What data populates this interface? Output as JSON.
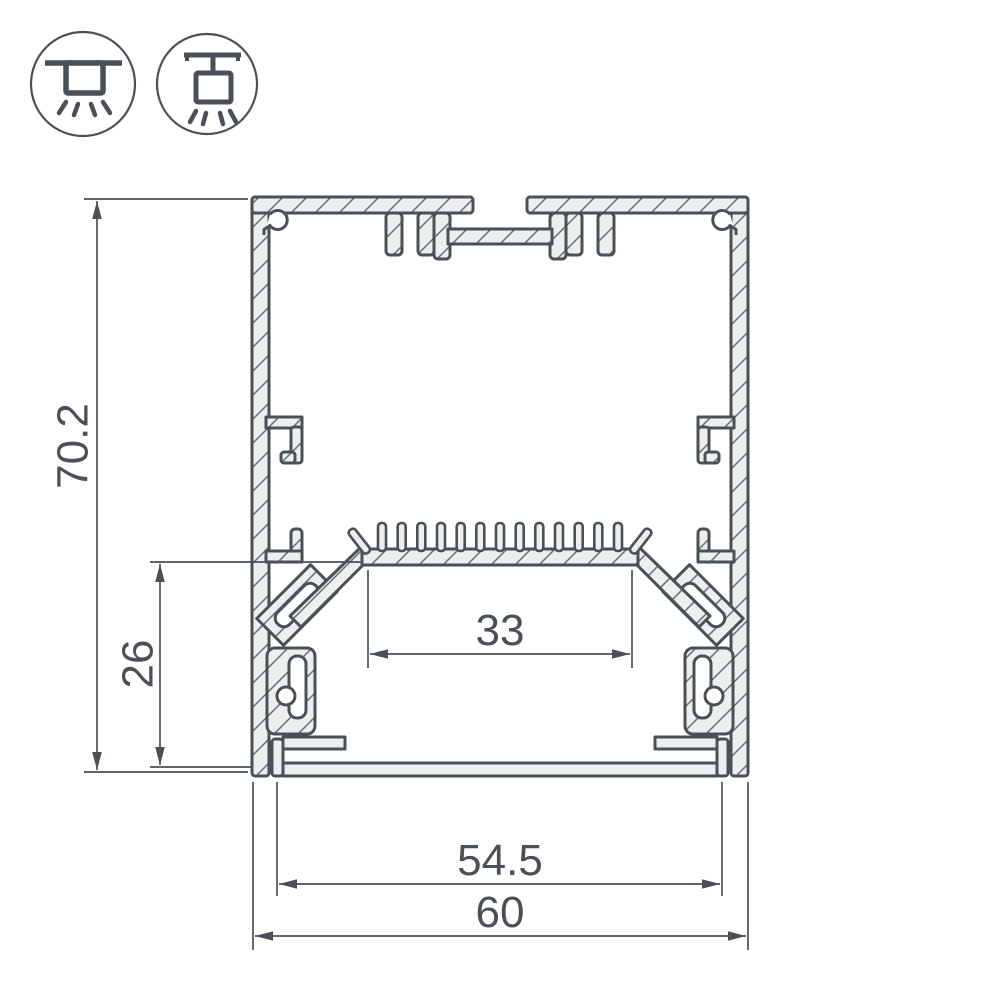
{
  "icons": {
    "surface_mounted": "surface-mounted-luminaire",
    "suspended": "suspended-luminaire"
  },
  "dimensions": {
    "overall_height": "70.2",
    "cavity_height": "26",
    "led_shelf_width": "33",
    "inner_width": "54.5",
    "overall_width": "60"
  },
  "colors": {
    "line": "#4a5156",
    "metal_fill": "#edefef",
    "hatch": "#6d767d",
    "background": "#ffffff"
  }
}
